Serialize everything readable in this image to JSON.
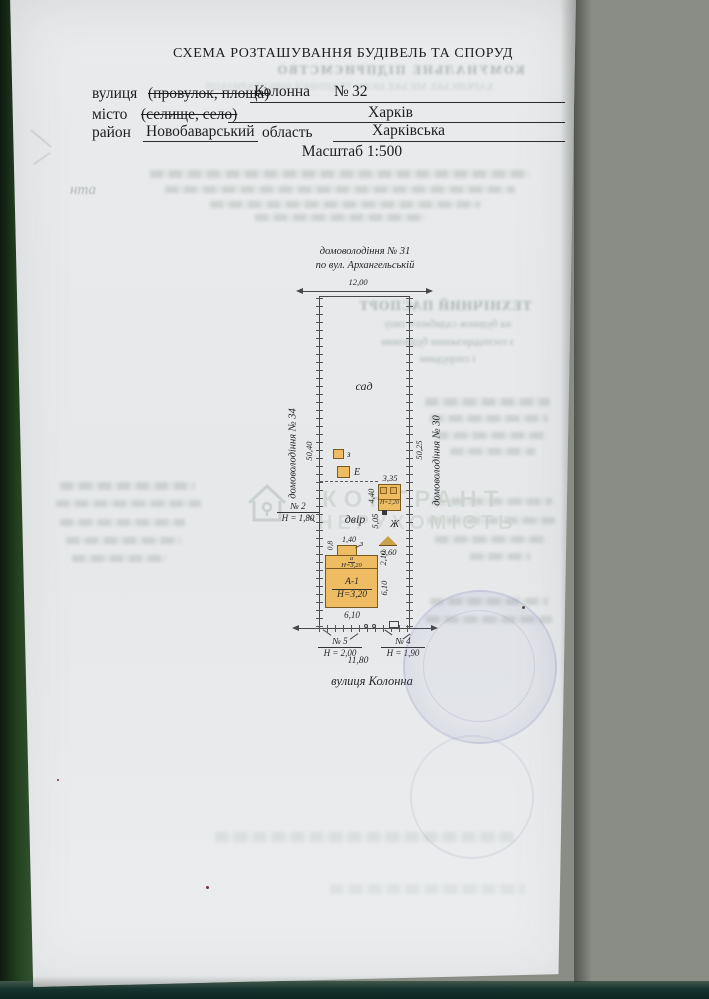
{
  "header": {
    "title": "СХЕМА РОЗТАШУВАННЯ БУДІВЕЛЬ ТА СПОРУД",
    "street_label": "вулиця",
    "street_options_struck": "(провулок, площа)",
    "street_value": "Колонна",
    "number_sign": "№",
    "house_number": "32",
    "city_label": "місто",
    "city_options_struck": "(селище, село)",
    "city_value": "Харків",
    "district_label": "район",
    "district_value": "Новобаварський",
    "region_label": "область",
    "region_value": "Харківська",
    "scale": "Масштаб 1:500"
  },
  "plan": {
    "north_neighbor": "домоволодіння № 31",
    "north_neighbor_street": "по вул. Архангельській",
    "front_width": "12,00",
    "west_neighbor": "домоволодіння № 34",
    "west_side_length": "50,40",
    "east_neighbor": "домоволодіння № 30",
    "east_side_length": "50,25",
    "garden": "сад",
    "yard": "двір",
    "shed_z": "з",
    "shed_e": "Е",
    "shed_zh": "Ж",
    "zh_width": "3,35",
    "zh_depth": "4,40",
    "zh_height": "Н=2,20",
    "gap_dim": "5,05",
    "canopy_width": "2,60",
    "porch_width": "1,40",
    "porch_depth": "0,8",
    "porch_label": "з",
    "annex_label": "а",
    "annex_height": "Н=3,20",
    "dim_2_10": "2,10",
    "house_label": "А-1",
    "house_height": "Н=3,20",
    "house_depth": "6,10",
    "house_width": "6,10",
    "fence2_no": "№ 2",
    "fence2_h": "Н = 1,80",
    "fence5_no": "№ 5",
    "fence5_h": "Н = 2,00",
    "fence4_no": "№ 4",
    "fence4_h": "Н = 1,90",
    "street_width": "11,80",
    "street_name": "вулиця Колонна"
  },
  "watermark": {
    "line1": "КОНГРАНТ",
    "line2": "НЕРУХОМІСТЬ"
  },
  "bleed": {
    "org1": "КОМУНАЛЬНЕ ПІДПРИЄМСТВО",
    "org2": "ХАРКІВСЬКЕ МІСЬКЕ БЮРО ТЕХНІЧНОЇ ІНВЕНТАРИЗАЦІЇ",
    "passport_title": "ТЕХНІЧНИЙ ПАСПОРТ",
    "passport_l2": "на будинок садибного типу",
    "passport_l3": "з господарськими будівлями",
    "passport_l4": "і спорудами",
    "pencil_note": "нта"
  },
  "colors": {
    "building_fill": "#eebc62",
    "building_border": "#7a5a1e",
    "plan_line": "#47474a",
    "stamp_ink": "#696fae",
    "table_green": "#24421f",
    "background_grey": "#8a8d85"
  }
}
